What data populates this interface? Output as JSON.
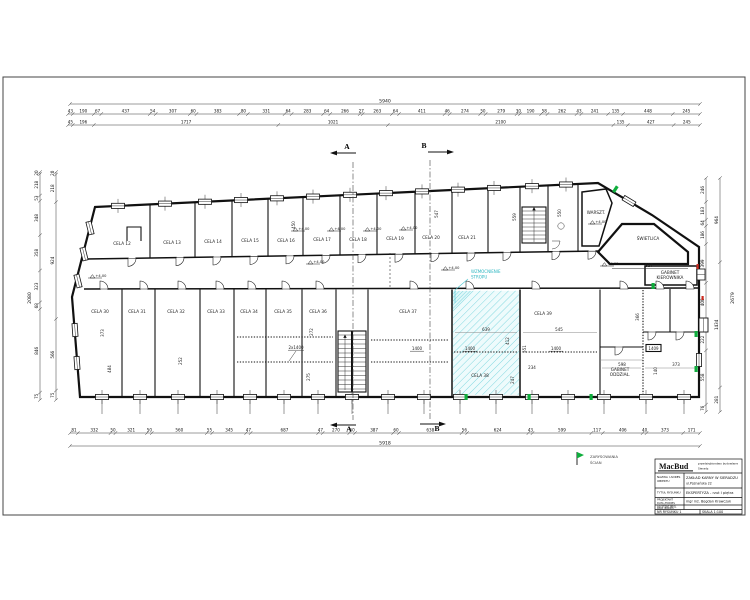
{
  "dims": {
    "top_total": [
      "5940"
    ],
    "top_row1": [
      43,
      190,
      67,
      437,
      54,
      307,
      60,
      383,
      80,
      331,
      64,
      283,
      64,
      266,
      27,
      263,
      64,
      411,
      46,
      274,
      50,
      279,
      30,
      190,
      58,
      262,
      43,
      241,
      135,
      448,
      245
    ],
    "top_row2": [
      45,
      196,
      1717,
      1021,
      2100,
      135,
      427,
      245
    ],
    "bottom_row1": [
      81,
      332,
      50,
      321,
      50,
      560,
      55,
      345,
      47,
      687,
      47,
      270,
      60,
      387,
      60,
      638,
      56,
      624,
      43,
      599,
      117,
      406,
      40,
      373,
      171
    ],
    "bottom_total": [
      "5918"
    ],
    "left_col1": [
      20,
      218,
      53,
      348,
      358,
      323,
      68,
      846,
      75
    ],
    "left_col2": [
      20,
      218,
      924,
      566,
      75
    ],
    "left_total": "2080",
    "right_col1": [
      246,
      183,
      64,
      186,
      399,
      400,
      72,
      222,
      558,
      76
    ],
    "right_col2": [
      964,
      1434,
      281
    ],
    "right_total": "2679"
  },
  "sections": {
    "a": "A",
    "b": "B"
  },
  "rooms": {
    "top": [
      "CELA 12",
      "CELA 13",
      "CELA 14",
      "CELA 15",
      "CELA 16",
      "CELA 17",
      "CELA 18",
      "CELA 19",
      "CELA 20",
      "CELA 21"
    ],
    "bottom": [
      "CELA 30",
      "CELA 31",
      "CELA 32",
      "CELA 33",
      "CELA 34",
      "CELA 35",
      "CELA 36",
      "CELA 37",
      "CELA 38",
      "CELA 39"
    ],
    "warsztat": "WARSZT.",
    "hall": "ŚWIETLICA",
    "gabinet1": [
      "GABINET",
      "KIEROWNIKA"
    ],
    "gabinet2": [
      "GABINET",
      "ODDZIAŁ."
    ]
  },
  "annotations": {
    "level": "+4.00",
    "lintel": "1400",
    "lintel_box": "1409",
    "lintel2": "2x1400",
    "hall_dim": "827",
    "reinforce1": "WZMOCNIENIE",
    "reinforce2": "STROPU",
    "v450": "450",
    "v547": "547",
    "v550": "550",
    "v559": "559",
    "d373": "373",
    "d484": "484",
    "d252": "252",
    "d272": "272",
    "d275": "275",
    "d412": "412",
    "d551": "551",
    "d247": "247",
    "d639": "639",
    "d545": "545",
    "d234": "234",
    "d598": "598",
    "d373b": "373",
    "d366": "366",
    "d140": "140"
  },
  "legend": {
    "line1": "ZARYSOWANIA",
    "line2": "ŚCIAN"
  },
  "titleblock": {
    "logo": "MacBud",
    "logo_sub1": "przedsiębiorstwo budowlane",
    "logo_sub2": "Sieradz",
    "f1_label1": "NAZWA I ADRES",
    "f1_label2": "OBIEKTU",
    "f1_value1": "ZAKŁAD KARNY W SIERADZU",
    "f1_value2": "ul.Poznańska 22",
    "f2_label": "TYTUŁ RYSUNKU",
    "f2_value": "EKSPERTYZA - rzut I piętra",
    "f3_label1": "PROJEKTANT",
    "f3_label2": "DATA /PODPIS",
    "f3_value": "mgr inż. Bogdan Krawczyk",
    "f4_label1": "ASYSTENT PROJ.",
    "f4_label2": "DATA /PODPIS",
    "f5_label": "NR RYSUNKU  1",
    "f6_label": "SKALA  1:100"
  }
}
